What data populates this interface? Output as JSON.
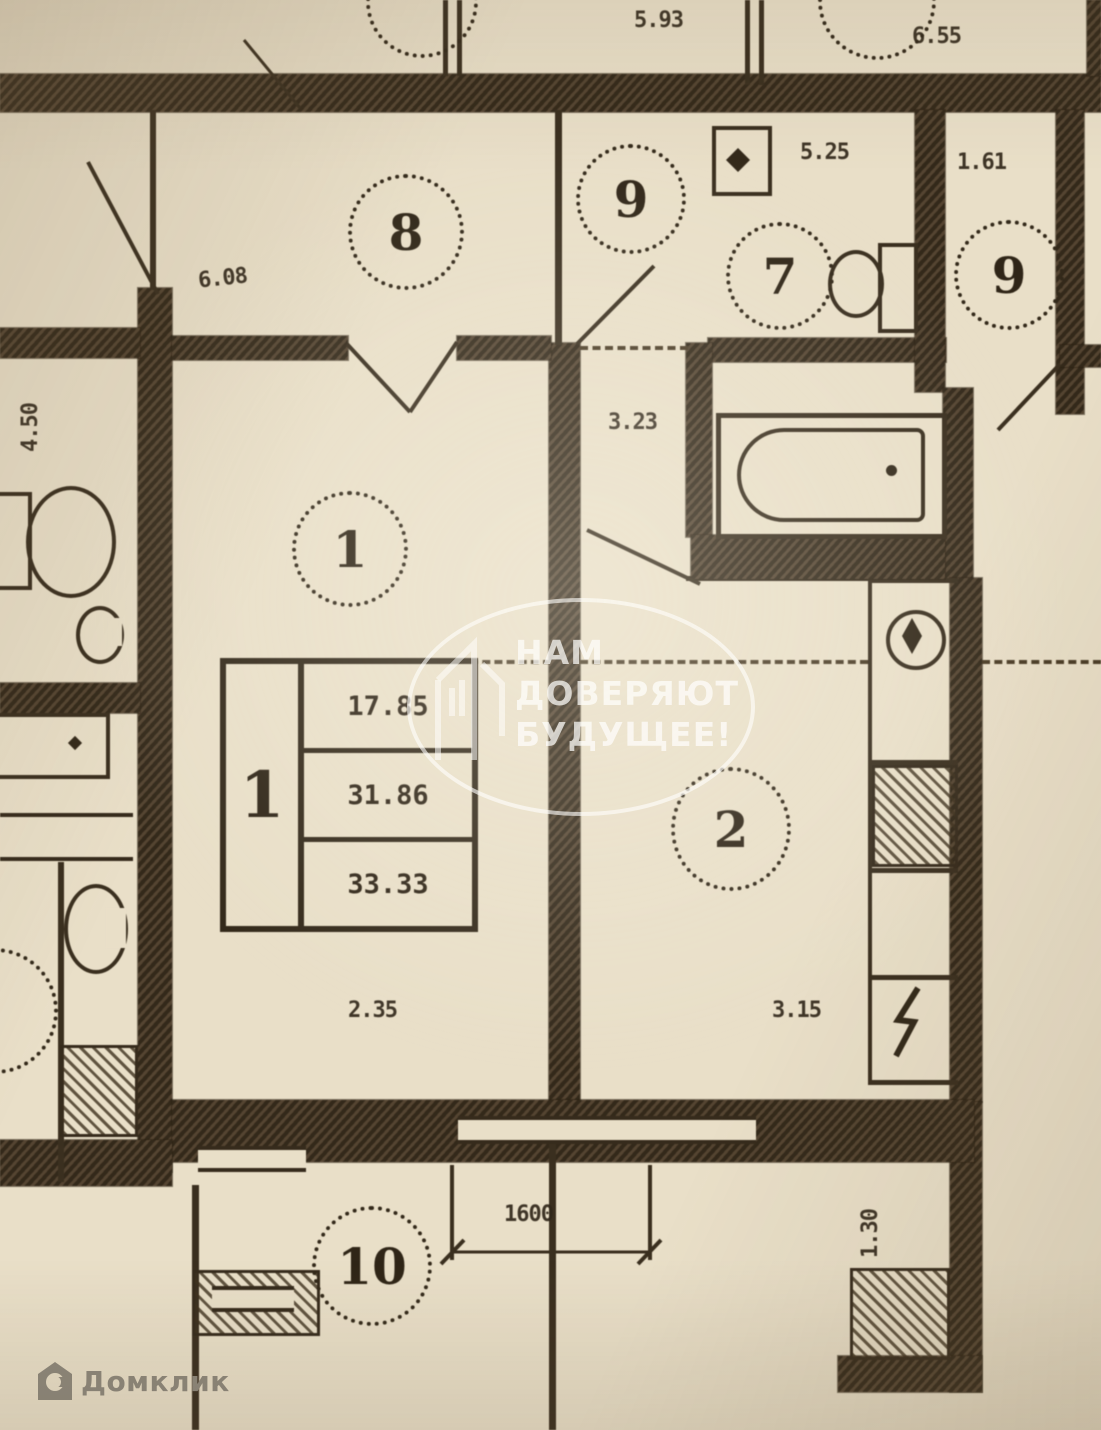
{
  "watermark": {
    "line1": "НАМ",
    "line2": "ДОВЕРЯЮТ",
    "line3": "БУДУЩЕЕ!"
  },
  "brand": {
    "name": "Домклик"
  },
  "rooms": {
    "r8": "8",
    "r9": "9",
    "r7": "7",
    "r9_right": "9",
    "r1": "1",
    "r2": "2",
    "r10": "10"
  },
  "info_table": {
    "apartment_no": "1",
    "row1": "17.85",
    "row2": "31.86",
    "row3": "33.33"
  },
  "dims": {
    "top_center": "5.93",
    "top_right": "6.55",
    "room8_width": "6.08",
    "left_height": "4.50",
    "room7_width": "5.25",
    "right_width": "1.61",
    "hall_width": "3.23",
    "room1_width": "2.35",
    "room2_width": "3.15",
    "balcony_width": "1600",
    "loggia_depth": "1.30"
  }
}
